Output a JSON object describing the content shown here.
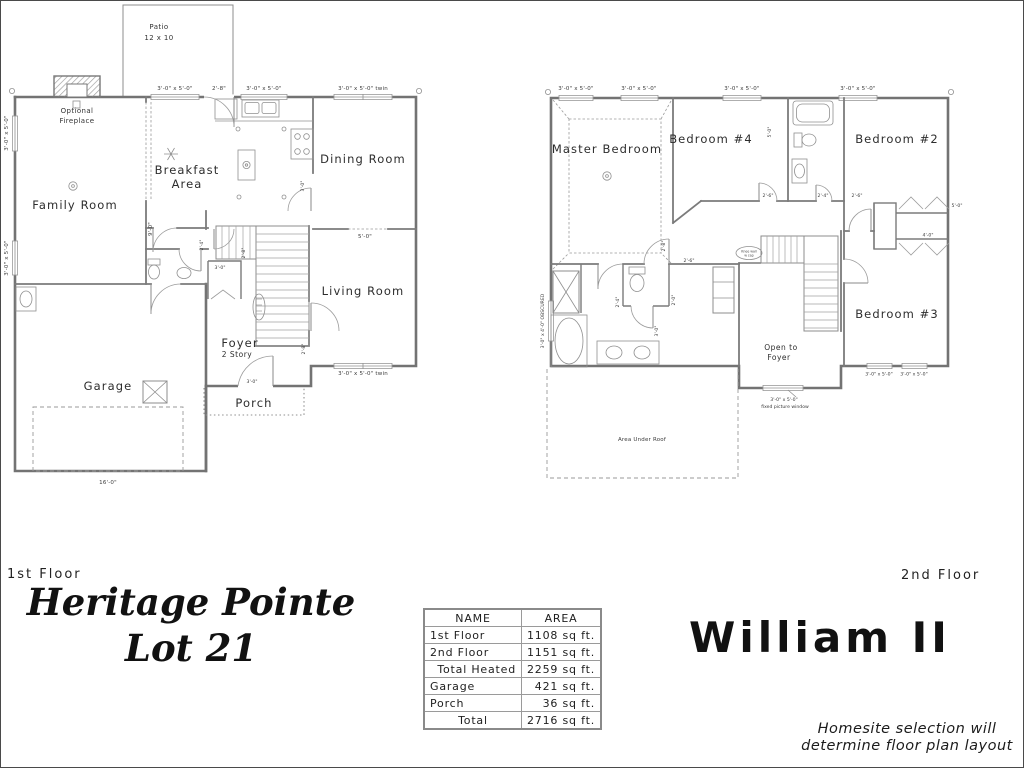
{
  "accent_colors": {
    "line_gray": "#7b7b7b",
    "text_dark": "#1e1e1e",
    "paper": "#ffffff"
  },
  "title_block": {
    "first_floor_tag": "1st Floor",
    "second_floor_tag": "2nd Floor",
    "community_line1": "Heritage Pointe",
    "community_line2": "Lot 21",
    "plan_name": "William II",
    "disclaimer_line1": "Homesite selection will",
    "disclaimer_line2": "determine floor plan layout"
  },
  "area_table": {
    "headers": [
      "NAME",
      "AREA"
    ],
    "rows": [
      {
        "name": "1st Floor",
        "area": "1108 sq ft."
      },
      {
        "name": "2nd Floor",
        "area": "1151 sq ft."
      },
      {
        "name": "Total Heated",
        "area": "2259 sq ft."
      },
      {
        "name": "Garage",
        "area": "421 sq ft."
      },
      {
        "name": "Porch",
        "area": "36 sq ft."
      },
      {
        "name": "Total",
        "area": "2716 sq ft."
      }
    ]
  },
  "first_floor": {
    "rooms": {
      "family_room": "Family Room",
      "breakfast_l1": "Breakfast",
      "breakfast_l2": "Area",
      "dining_room": "Dining Room",
      "living_room": "Living Room",
      "foyer": "Foyer",
      "foyer_sub": "2 Story",
      "garage": "Garage",
      "porch": "Porch"
    },
    "annotations": {
      "patio_l1": "Patio",
      "patio_l2": "12 x 10",
      "fireplace_l1": "Optional",
      "fireplace_l2": "Fireplace"
    },
    "dims": {
      "top_win_1": "3'-0\" x 5'-0\"",
      "top_door": "2'-8\"",
      "top_win_2": "3'-0\" x 5'-0\"",
      "top_win_twin": "3'-0\" x 5'-0\" twin",
      "left_win_1": "3'-0\" x 5'-0\"",
      "left_win_2": "3'-0\" x 5'-0\"",
      "bottom_win_twin": "3'-0\" x 5'-0\" twin",
      "garage_width": "16'-0\"",
      "front_door": "3'-0\"",
      "dining_opening": "5'-0\"",
      "family_opening": "9'-0\"",
      "hall_door": "3'-0\"",
      "closet_door": "2'-8\"",
      "stair_dim": "2'-4\"",
      "living_door": "2'-8\"",
      "kitchen_door": "3'-0\""
    }
  },
  "second_floor": {
    "rooms": {
      "master": "Master Bedroom",
      "bedroom4": "Bedroom #4",
      "bedroom2": "Bedroom #2",
      "bedroom3": "Bedroom #3",
      "open_l1": "Open to",
      "open_l2": "Foyer"
    },
    "annotations": {
      "area_under_roof": "Area Under Roof",
      "fixed_win_l1": "3'-0\" x 5'-0\"",
      "fixed_win_l2": "fixed picture window",
      "knee_l1": "Knee wall",
      "knee_l2": "w cap"
    },
    "dims": {
      "top_win_1": "3'-0\" x 5'-0\"",
      "top_win_2": "3'-0\" x 5'-0\"",
      "top_win_3": "3'-0\" x 5'-0\"",
      "top_win_4": "3'-0\" x 5'-0\"",
      "obscured_win": "3'-0\" x 4'-0\" OBSCURED",
      "b3_win_1": "3'-0\" x 5'-0\"",
      "b3_win_2": "3'-0\" x 5'-0\"",
      "b2_closet": "5'-0\"",
      "b3_closet": "4'-0\"",
      "b4_door": "2'-6\"",
      "bath_door": "2'-4\"",
      "b2_door": "2'-6\"",
      "master_door": "2'-8\"",
      "hall_bath_door": "2'-6\"",
      "wc_door": "2'-0\"",
      "bath_inner": "2'-4\"",
      "vanity_dim": "3'-0\"",
      "b4_closet": "5'-0\""
    }
  }
}
